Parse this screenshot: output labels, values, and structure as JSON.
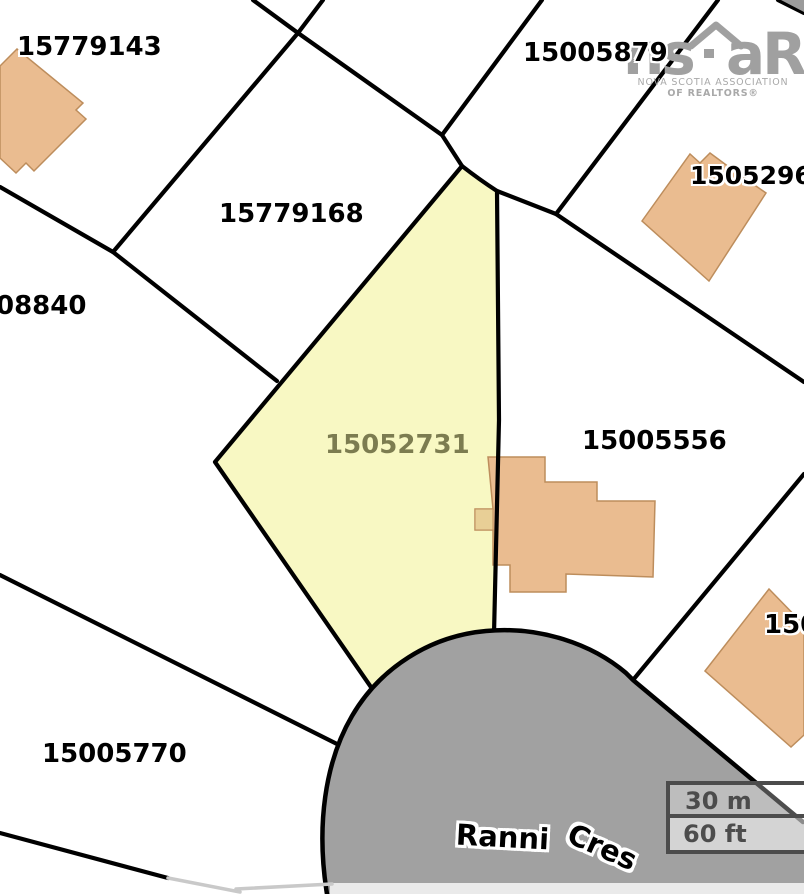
{
  "parcels": [
    {
      "pid": "15779143"
    },
    {
      "pid": "15005879"
    },
    {
      "pid": "15052960"
    },
    {
      "pid": "15779168"
    },
    {
      "pid": "08840"
    },
    {
      "pid": "15052731"
    },
    {
      "pid": "15005556"
    },
    {
      "pid": "15005770"
    },
    {
      "pid": "150"
    }
  ],
  "subject_parcel": {
    "pid": "15052731",
    "highlighted": true
  },
  "road": {
    "name_first": "Ranni",
    "name_second": "Cres"
  },
  "scale_bar": {
    "metric": "30 m",
    "imperial": "60 ft"
  },
  "logo": {
    "text_left": "ns",
    "text_right": "aR",
    "caption_line1": "NOVA SCOTIA ASSOCIATION",
    "caption_line2": "OF REALTORS®"
  },
  "colors": {
    "highlight_fill": "#f8f8c3",
    "highlight_label": "#7c7c50",
    "building_fill": "#eabc90",
    "building_stroke": "#bd8d5c",
    "road_fill": "#a1a1a1",
    "road_shoulder": "#eaeaea",
    "boundary_line": "#000000",
    "faint_line": "#c9c9c9",
    "scale_bar_line": "#4c4c4c",
    "logo_gray": "#a0a0a0"
  }
}
